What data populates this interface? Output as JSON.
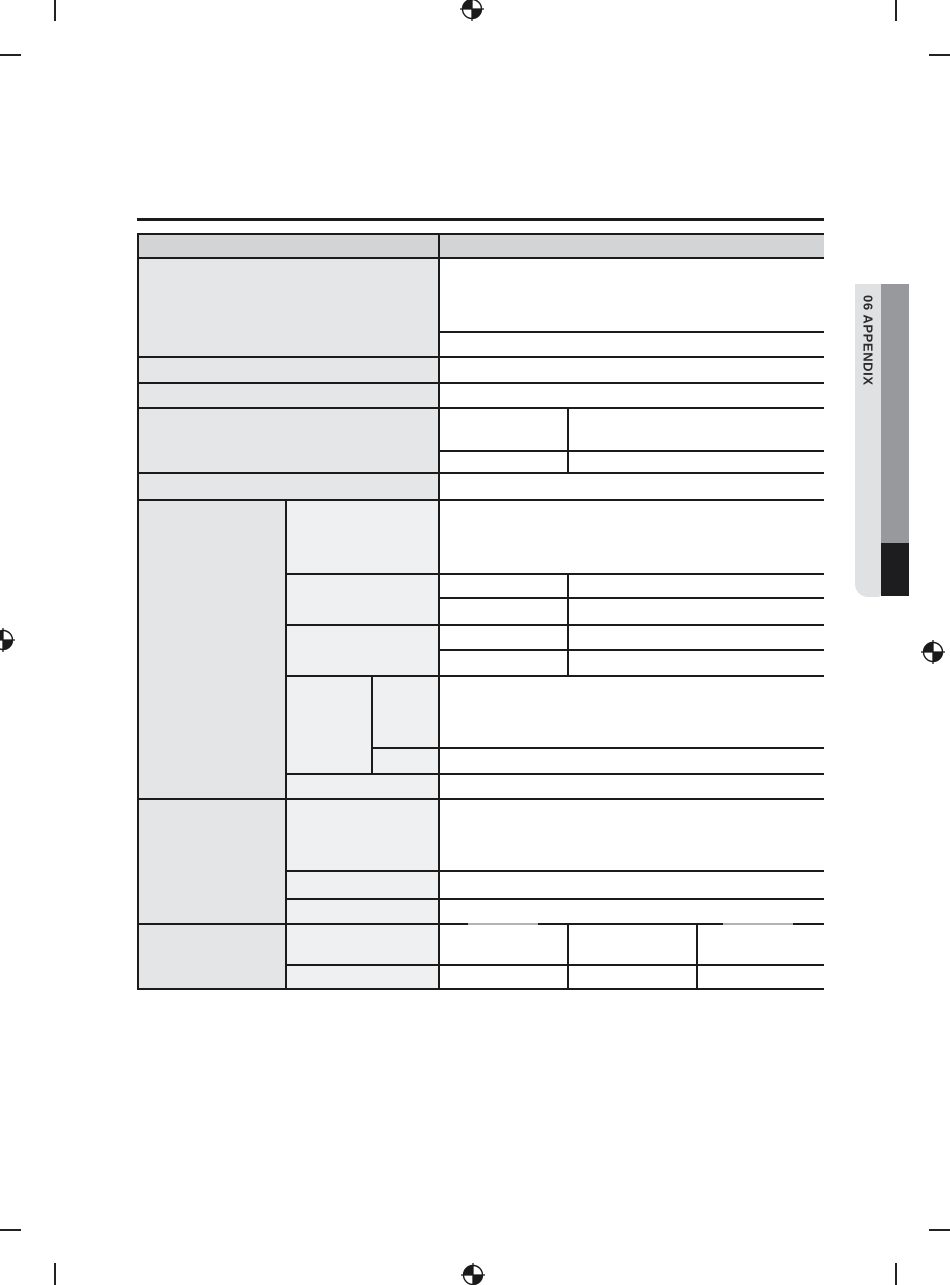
{
  "page": {
    "kind": "printed manual appendix page, blank specifications table",
    "background_color": "#ffffff"
  },
  "sidebar_tab": {
    "label": "06 APPENDIX",
    "tab_color": "#e0e1e3",
    "bar_color": "#97999c",
    "bar_accent_color": "#1d1d1f",
    "text_color": "#2b2b2b"
  },
  "table": {
    "all_cells_blank": true,
    "header_row": {
      "left_cell_text": "",
      "right_cell_text": ""
    },
    "line_color": "#1b1b1b",
    "header_fill": "#d3d4d6",
    "label_column_fill": "#e5e6e8",
    "category_column_fill": "#e4e5e7",
    "subcategory_column_fill": "#eff0f1",
    "value_area_fill": "#ffffff"
  },
  "print_marks": {
    "registration_marks": [
      "top-center",
      "left-edge",
      "right-edge",
      "bottom-center"
    ],
    "crop_marks": [
      "top-left",
      "top-right",
      "bottom-left",
      "bottom-right"
    ],
    "mark_color": "#1a1a1a"
  }
}
